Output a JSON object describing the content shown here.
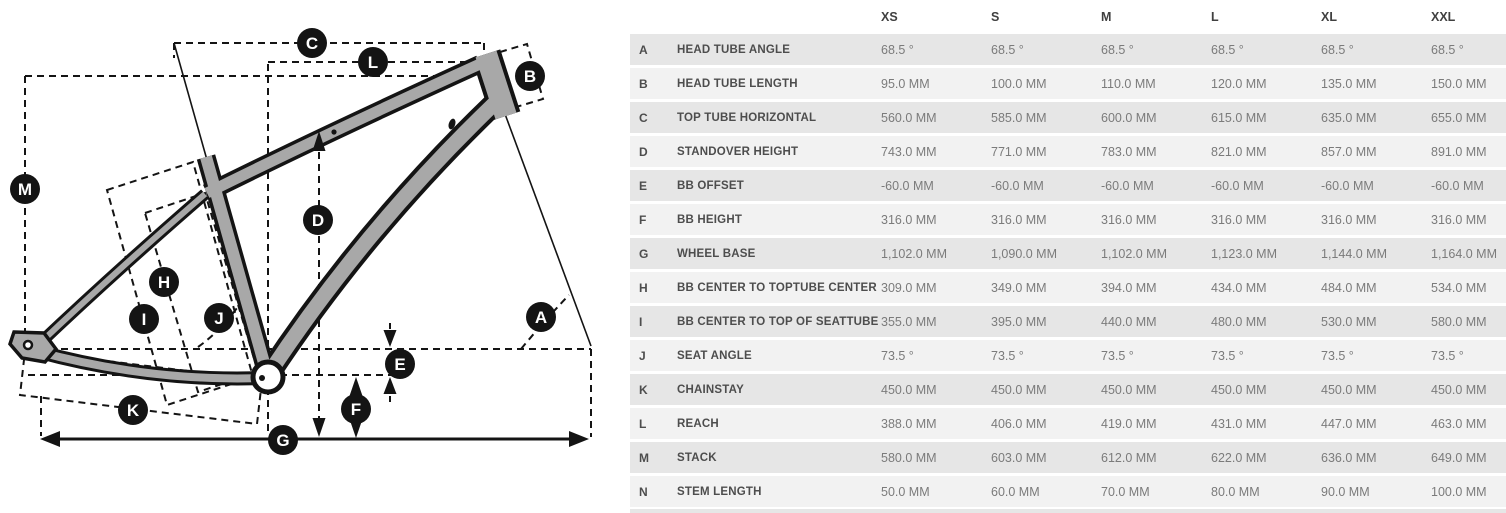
{
  "title": "Bike frame geometry",
  "colors": {
    "frame_fill": "#a8a8a8",
    "line_ink": "#141414",
    "row_dark": "#e6e6e6",
    "row_light": "#f2f2f2",
    "label_text": "#4d4d4d",
    "value_text": "#7b7b7b"
  },
  "diagram": {
    "markers": [
      {
        "letter": "A",
        "x": 541,
        "y": 317
      },
      {
        "letter": "B",
        "x": 530,
        "y": 76
      },
      {
        "letter": "C",
        "x": 312,
        "y": 43
      },
      {
        "letter": "D",
        "x": 318,
        "y": 220
      },
      {
        "letter": "E",
        "x": 400,
        "y": 364
      },
      {
        "letter": "F",
        "x": 356,
        "y": 409
      },
      {
        "letter": "G",
        "x": 283,
        "y": 440
      },
      {
        "letter": "H",
        "x": 164,
        "y": 282
      },
      {
        "letter": "I",
        "x": 144,
        "y": 319
      },
      {
        "letter": "J",
        "x": 219,
        "y": 318
      },
      {
        "letter": "K",
        "x": 133,
        "y": 410
      },
      {
        "letter": "L",
        "x": 373,
        "y": 62
      },
      {
        "letter": "M",
        "x": 25,
        "y": 189
      }
    ]
  },
  "table": {
    "columns": [
      "XS",
      "S",
      "M",
      "L",
      "XL",
      "XXL"
    ],
    "rows": [
      {
        "letter": "A",
        "name": "HEAD TUBE ANGLE",
        "values": [
          "68.5 °",
          "68.5 °",
          "68.5 °",
          "68.5 °",
          "68.5 °",
          "68.5 °"
        ]
      },
      {
        "letter": "B",
        "name": "HEAD TUBE LENGTH",
        "values": [
          "95.0 MM",
          "100.0 MM",
          "110.0 MM",
          "120.0 MM",
          "135.0 MM",
          "150.0 MM"
        ]
      },
      {
        "letter": "C",
        "name": "TOP TUBE HORIZONTAL",
        "values": [
          "560.0 MM",
          "585.0 MM",
          "600.0 MM",
          "615.0 MM",
          "635.0 MM",
          "655.0 MM"
        ]
      },
      {
        "letter": "D",
        "name": "STANDOVER HEIGHT",
        "values": [
          "743.0 MM",
          "771.0 MM",
          "783.0 MM",
          "821.0 MM",
          "857.0 MM",
          "891.0 MM"
        ]
      },
      {
        "letter": "E",
        "name": "BB OFFSET",
        "values": [
          "-60.0 MM",
          "-60.0 MM",
          "-60.0 MM",
          "-60.0 MM",
          "-60.0 MM",
          "-60.0 MM"
        ]
      },
      {
        "letter": "F",
        "name": "BB HEIGHT",
        "values": [
          "316.0 MM",
          "316.0 MM",
          "316.0 MM",
          "316.0 MM",
          "316.0 MM",
          "316.0 MM"
        ]
      },
      {
        "letter": "G",
        "name": "WHEEL BASE",
        "values": [
          "1,102.0 MM",
          "1,090.0 MM",
          "1,102.0 MM",
          "1,123.0 MM",
          "1,144.0 MM",
          "1,164.0 MM"
        ]
      },
      {
        "letter": "H",
        "name": "BB CENTER TO TOPTUBE CENTER",
        "values": [
          "309.0 MM",
          "349.0 MM",
          "394.0 MM",
          "434.0 MM",
          "484.0 MM",
          "534.0 MM"
        ]
      },
      {
        "letter": "I",
        "name": "BB CENTER TO TOP OF SEATTUBE",
        "values": [
          "355.0 MM",
          "395.0 MM",
          "440.0 MM",
          "480.0 MM",
          "530.0 MM",
          "580.0 MM"
        ]
      },
      {
        "letter": "J",
        "name": "SEAT ANGLE",
        "values": [
          "73.5 °",
          "73.5 °",
          "73.5 °",
          "73.5 °",
          "73.5 °",
          "73.5 °"
        ]
      },
      {
        "letter": "K",
        "name": "CHAINSTAY",
        "values": [
          "450.0 MM",
          "450.0 MM",
          "450.0 MM",
          "450.0 MM",
          "450.0 MM",
          "450.0 MM"
        ]
      },
      {
        "letter": "L",
        "name": "REACH",
        "values": [
          "388.0 MM",
          "406.0 MM",
          "419.0 MM",
          "431.0 MM",
          "447.0 MM",
          "463.0 MM"
        ]
      },
      {
        "letter": "M",
        "name": "STACK",
        "values": [
          "580.0 MM",
          "603.0 MM",
          "612.0 MM",
          "622.0 MM",
          "636.0 MM",
          "649.0 MM"
        ]
      },
      {
        "letter": "N",
        "name": "STEM LENGTH",
        "values": [
          "50.0 MM",
          "60.0 MM",
          "70.0 MM",
          "80.0 MM",
          "90.0 MM",
          "100.0 MM"
        ]
      }
    ]
  }
}
